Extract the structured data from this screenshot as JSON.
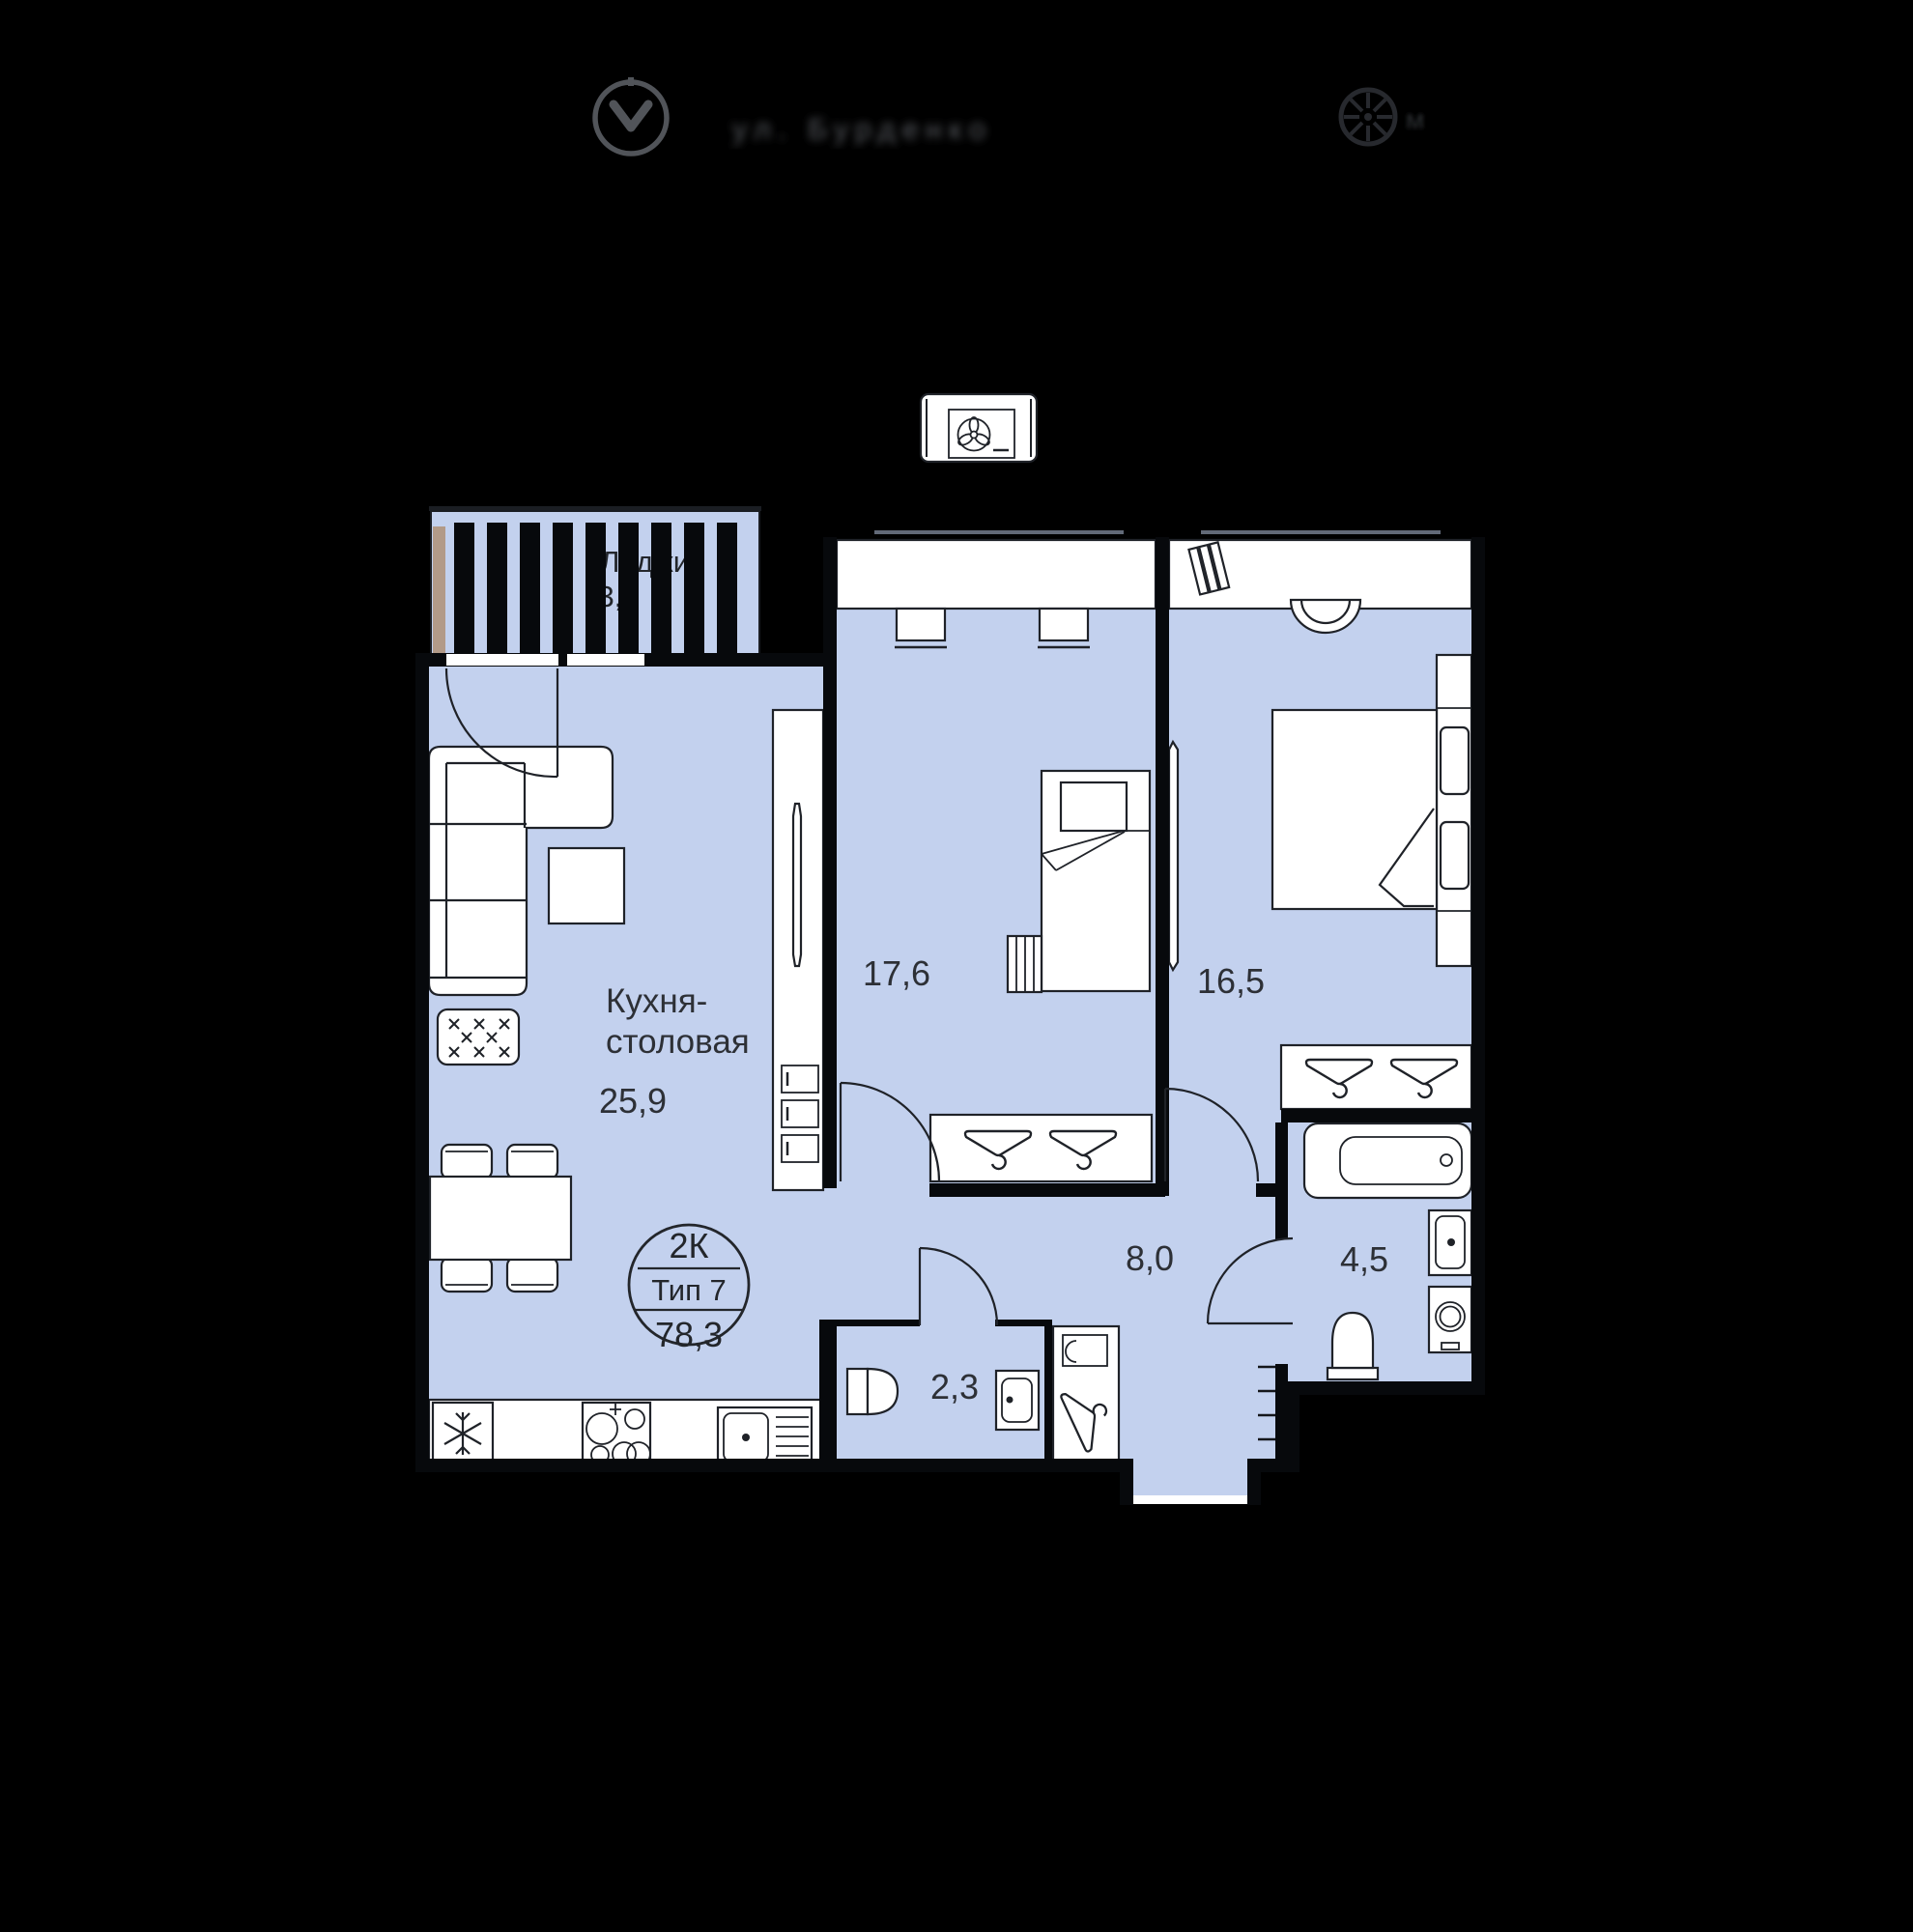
{
  "header": {
    "location_label": "ул. Бурденко",
    "north_unit_label": "м"
  },
  "badge": {
    "rooms": "2К",
    "type": "Тип 7",
    "area": "78,3"
  },
  "rooms": {
    "kitchen": {
      "label_line1": "Кухня-",
      "label_line2": "столовая",
      "area": "25,9"
    },
    "bedroom1": {
      "area": "17,6"
    },
    "bedroom2": {
      "area": "16,5"
    },
    "hallway": {
      "area": "8,0"
    },
    "bathroom": {
      "area": "4,5"
    },
    "wc": {
      "area": "2,3"
    },
    "loggia": {
      "label": "Лоджия",
      "area": "3,6"
    }
  },
  "colors": {
    "background": "#000000",
    "floor": "#c3d1ee",
    "wall": "#07090c",
    "furniture_stroke": "#1f2228",
    "text": "#2d3036",
    "loggia_wood": "#b29a88",
    "header_gray": "#5a5d63"
  }
}
